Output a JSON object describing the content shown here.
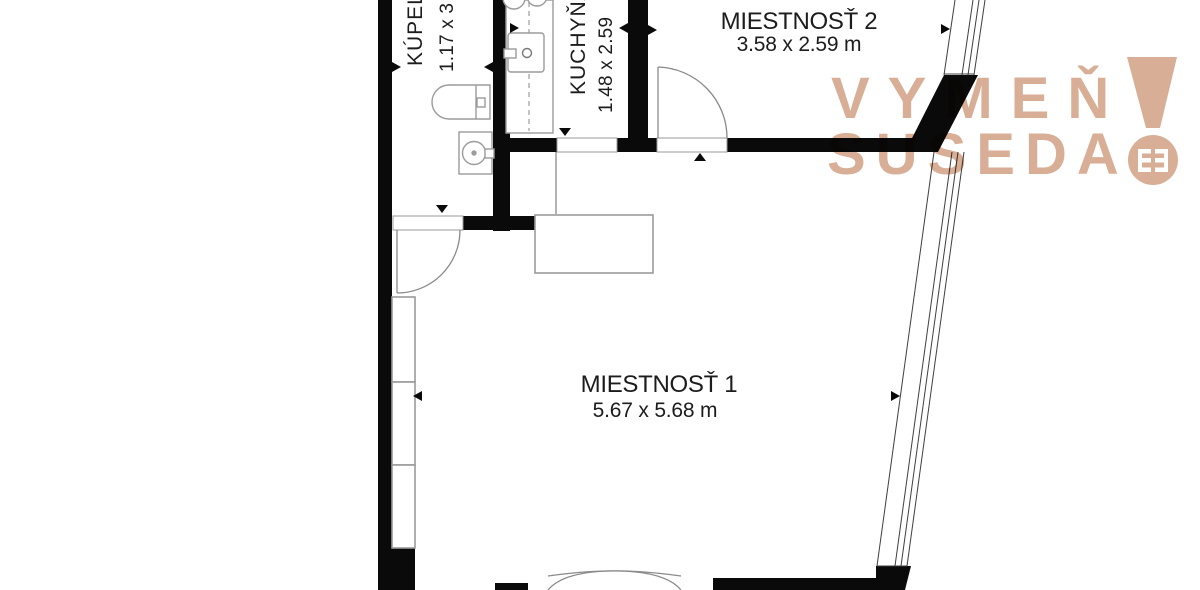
{
  "colors": {
    "wall": "#0a0a0a",
    "furniture_outline": "#9b9b9b",
    "window_line": "#3f3f3f",
    "door_arc": "#8a8a8a",
    "label_text": "#1c1c1c",
    "watermark": "#d9ae96",
    "background": "#ffffff"
  },
  "plan": {
    "rooms": [
      {
        "name": "MIESTNOSŤ 1",
        "dimensions": "5.67 x 5.68 m"
      },
      {
        "name": "MIESTNOSŤ 2",
        "dimensions": "3.58 x 2.59 m"
      },
      {
        "name": "KUCHYŇA",
        "dimensions": "1.48 x 2.59"
      },
      {
        "name": "KÚPEĽŇA",
        "dimensions": "1.17 x 3"
      }
    ],
    "fixtures": [
      "toilet",
      "washbasin",
      "kitchen-counter",
      "kitchen-sink",
      "hob-burners",
      "wardrobe",
      "double-entry-door",
      "window-wall"
    ]
  },
  "watermark": {
    "line1": "VYMEŇ",
    "line2": "SUSEDA",
    "mark": "!"
  }
}
